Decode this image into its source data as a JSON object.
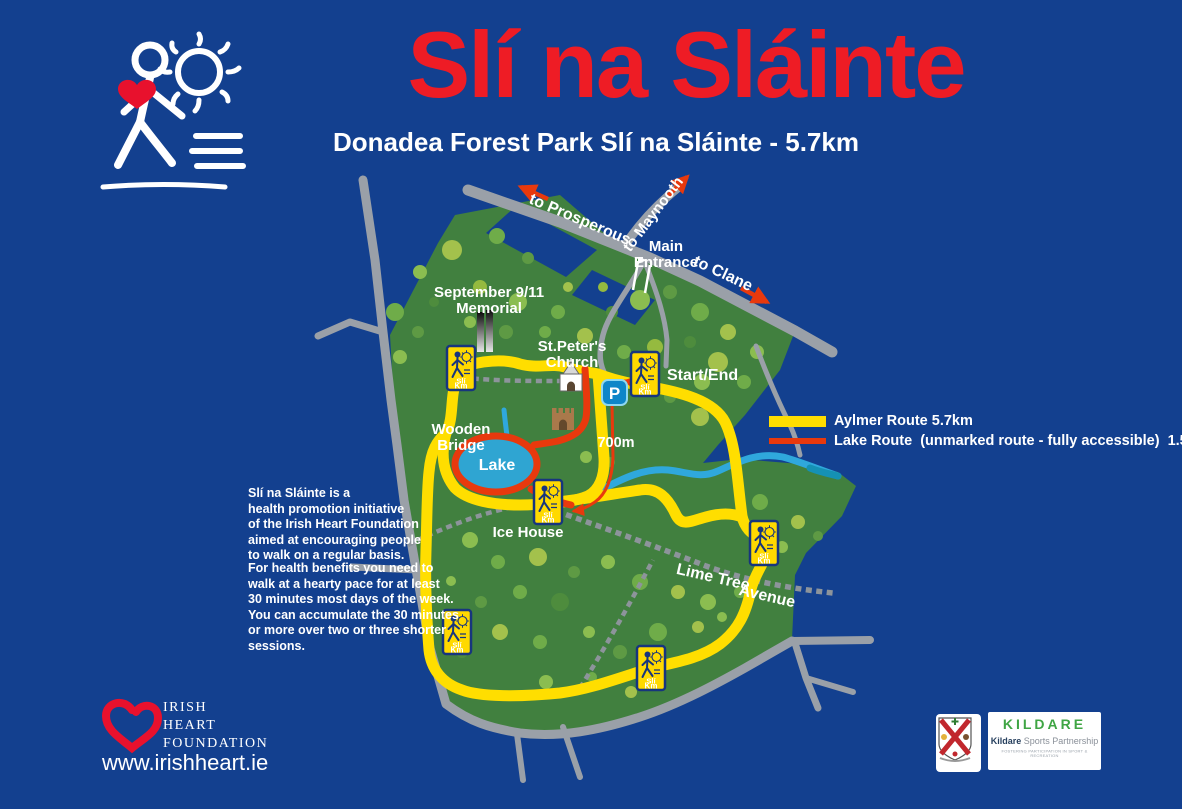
{
  "header": {
    "title": "Slí na Sláinte",
    "subtitle": "Donadea Forest Park Slí na Sláinte - 5.7km"
  },
  "info": {
    "para1_lines": [
      "Slí na Sláinte is a",
      "health promotion initiative",
      "of the Irish Heart Foundation",
      "aimed at encouraging people",
      "to walk on a regular basis."
    ],
    "para2_lines": [
      "For health benefits you need to",
      "walk at a hearty pace for at least",
      "30 minutes most days of the week.",
      "You can accumulate the 30 minutes",
      "or more over two or three shorter",
      "sessions."
    ]
  },
  "legend": {
    "aylmer_label": "Aylmer Route 5.7km",
    "lake_label": "Lake Route  (unmarked route - fully accessible)  1.5km",
    "aylmer_color": "#FFDE00",
    "lake_color": "#E8390D"
  },
  "map": {
    "labels": {
      "to_prosperous": "to Prosperous",
      "to_maynooth": "to Maynooth",
      "to_clane": "to Clane",
      "main_entrance_line1": "Main",
      "main_entrance_line2": "Entrance",
      "memorial_line1": "September 9/11",
      "memorial_line2": "Memorial",
      "church_line1": "St.Peter's",
      "church_line2": "Church",
      "start_end": "Start/End",
      "wooden_bridge_line1": "Wooden",
      "wooden_bridge_line2": "Bridge",
      "lake": "Lake",
      "distance_700m": "700m",
      "ice_house": "Ice House",
      "lime_tree": "Lime Tree",
      "avenue": "Avenue",
      "parking": "P"
    },
    "km_sign": {
      "sli": "Slí",
      "km": "Km"
    },
    "colors": {
      "background": "#13408F",
      "park_green": "#41803F",
      "road_gray": "#9AA0A8",
      "route_yellow": "#FFDE00",
      "route_red": "#E8390D",
      "water_blue": "#2FA8DC",
      "title_red": "#EE1C25"
    }
  },
  "footer": {
    "org_line1": "IRISH",
    "org_line2": "HEART",
    "org_line3": "FOUNDATION",
    "website": "www.irishheart.ie"
  },
  "partners": {
    "ksp_wordmark": "KILDARE",
    "ksp_name_bold": "Kildare",
    "ksp_name_rest": " Sports Partnership",
    "ksp_tagline": "FOSTERING PARTICIPATION IN SPORT & RECREATION"
  }
}
